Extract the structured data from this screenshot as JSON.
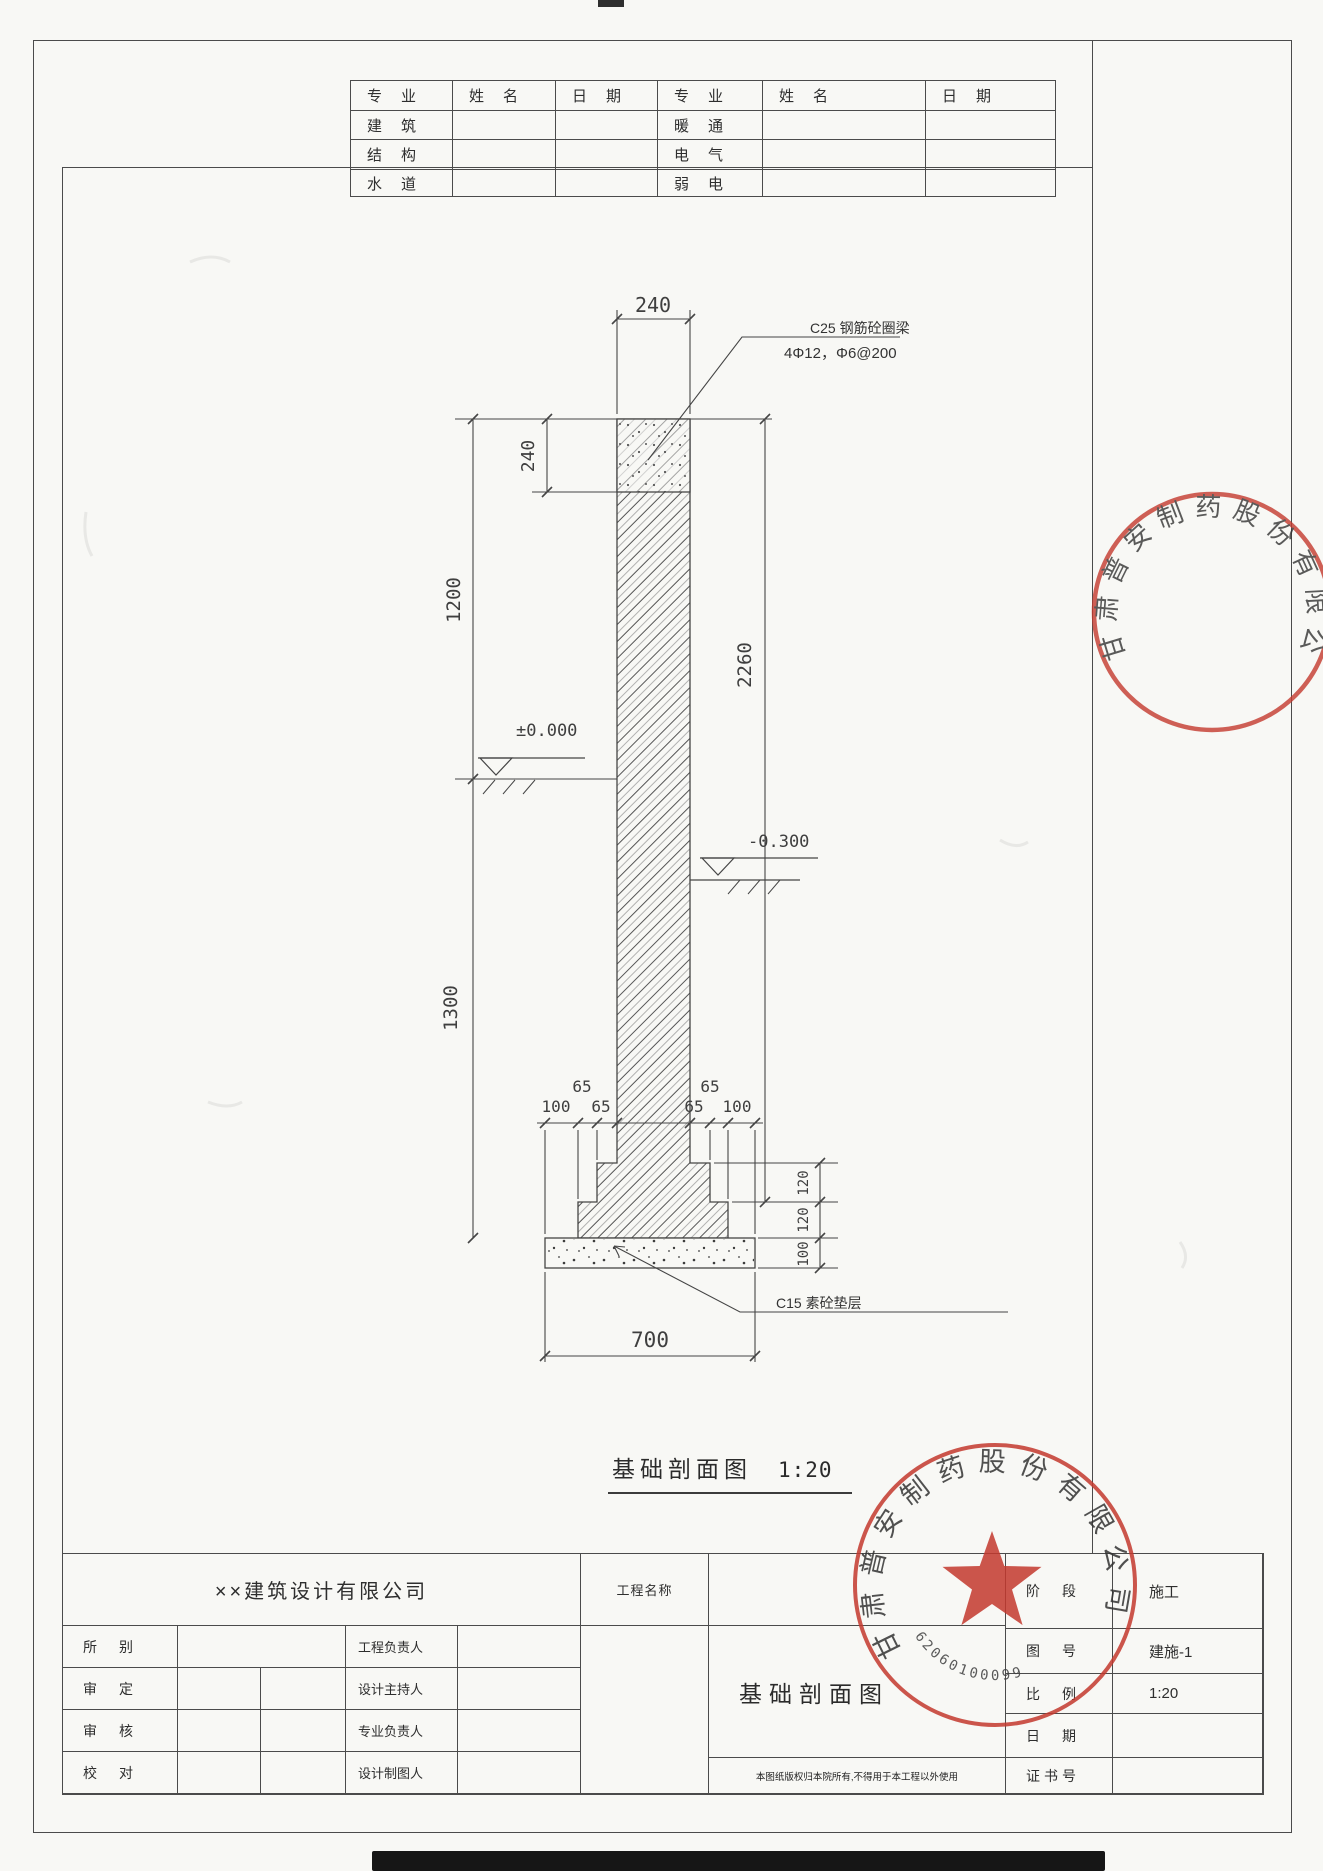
{
  "colors": {
    "ink": "#454545",
    "dim_text": "#3f3f3f",
    "stamp_red": "#c4392e",
    "paper": "#f8f8f5"
  },
  "top_table": {
    "headers": [
      "专　业",
      "姓　名",
      "日　期",
      "专　业",
      "姓　名",
      "日　期"
    ],
    "left_rows": [
      "建　筑",
      "结　构",
      "水　道"
    ],
    "right_rows": [
      "暖　通",
      "电　气",
      "弱　电"
    ]
  },
  "drawing": {
    "caption": "基础剖面图",
    "scale": "1:20",
    "ann_beam_1": "C25 钢筋砼圈梁",
    "ann_beam_2": "4Φ12，Φ6@200",
    "ann_pad": "C15 素砼垫层",
    "lvl_zero": "±0.000",
    "lvl_minus": "-0.300",
    "d_top": "240",
    "d_beam": "240",
    "d_upper": "1200",
    "d_lower": "1300",
    "d_total": "2260",
    "d65_l1": "65",
    "d100_l": "100",
    "d65_l2": "65",
    "d65_r1": "65",
    "d65_r2": "65",
    "d100_r": "100",
    "d_h120a": "120",
    "d_h120b": "120",
    "d_h100": "100",
    "d_pad_w": "700"
  },
  "title_block": {
    "company": "××建筑设计有限公司",
    "project_label": "工程名称",
    "drawing_name": "基础剖面图",
    "note": "本图纸版权归本院所有,不得用于本工程以外使用",
    "rows": [
      {
        "label": "所　别",
        "role": "工程负责人"
      },
      {
        "label": "审　定",
        "role": "设计主持人"
      },
      {
        "label": "审　核",
        "role": "专业负责人"
      },
      {
        "label": "校　对",
        "role": "设计制图人"
      }
    ],
    "right_rows": [
      {
        "label": "阶　段",
        "value": "施工"
      },
      {
        "label": "图　号",
        "value": "建施-1"
      },
      {
        "label": "比　例",
        "value": "1:20"
      },
      {
        "label": "日　期",
        "value": ""
      },
      {
        "label": "证书号",
        "value": ""
      }
    ]
  },
  "stamp": {
    "company": "甘肃普安制药股份有限公司",
    "serial": "62060100099"
  }
}
